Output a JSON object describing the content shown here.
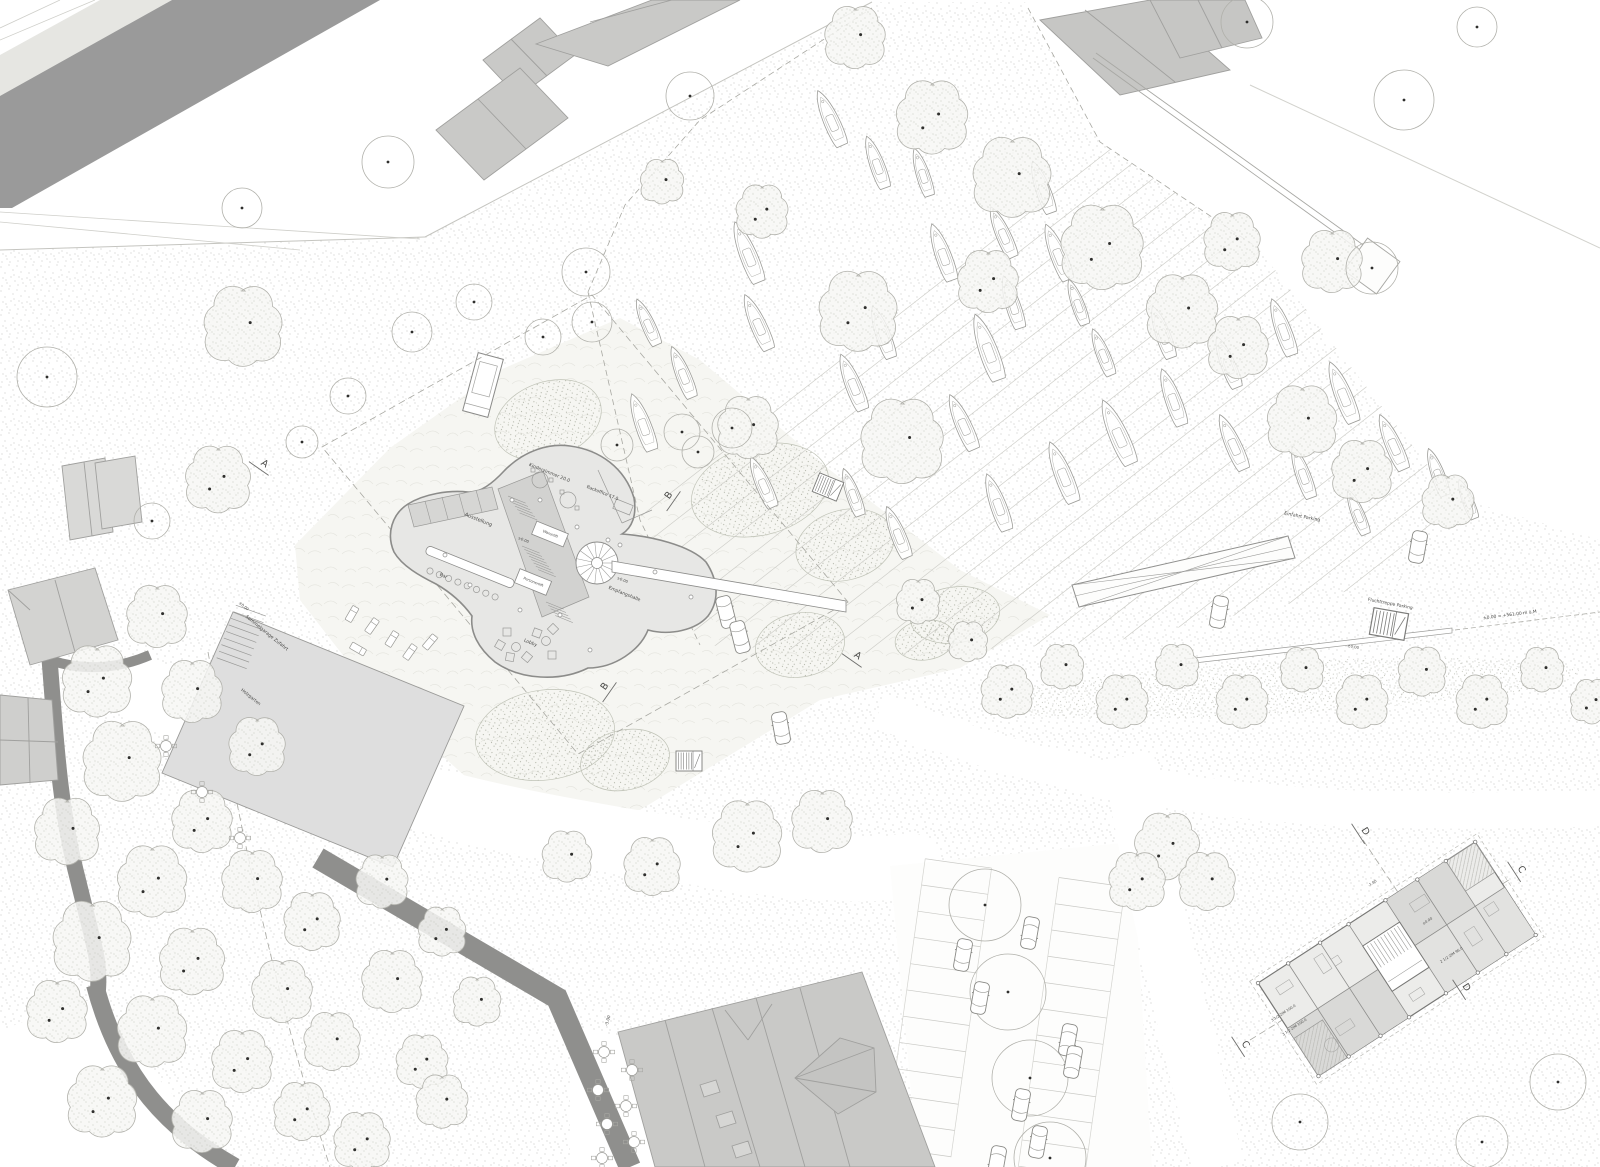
{
  "meta": {
    "type": "architectural-site-plan",
    "view": "top-down plan with marina, park, clover-shaped pavilion and apartment plan"
  },
  "colors": {
    "paper": "#ffffff",
    "road_dark": "#9a9a9a",
    "existing_building": "#c9c9c7",
    "main_building": "#e7e7e5",
    "core": "#d2d2d0",
    "outline": "#8c8c8a",
    "stipple": "#b9b9b3",
    "text": "#4a4a48"
  },
  "labels": [
    {
      "text": "Kinderzimmer 20.0",
      "x": 549,
      "y": 474,
      "rot": 22,
      "size": 4.6
    },
    {
      "text": "Backoffice 17.0",
      "x": 602,
      "y": 494,
      "rot": 22,
      "size": 4.4
    },
    {
      "text": "Ausstellung",
      "x": 478,
      "y": 521,
      "rot": 22,
      "size": 5
    },
    {
      "text": "Warenlift",
      "x": 550,
      "y": 535,
      "rot": 22,
      "size": 3.6
    },
    {
      "text": "Personenlift",
      "x": 533,
      "y": 583,
      "rot": 22,
      "size": 3.6
    },
    {
      "text": "Bar",
      "x": 443,
      "y": 577,
      "rot": 22,
      "size": 4.6
    },
    {
      "text": "Lobby",
      "x": 530,
      "y": 644,
      "rot": 22,
      "size": 4.6
    },
    {
      "text": "Empfangshalle",
      "x": 624,
      "y": 595,
      "rot": 22,
      "size": 4.6
    },
    {
      "text": "±0.00",
      "x": 523,
      "y": 541,
      "rot": 22,
      "size": 3.8
    },
    {
      "text": "±0.00",
      "x": 622,
      "y": 581,
      "rot": 22,
      "size": 3.8
    },
    {
      "text": "Sammelgarage Zufahrt",
      "x": 266,
      "y": 634,
      "rot": 39,
      "size": 4.6
    },
    {
      "text": "±0.00",
      "x": 243,
      "y": 607,
      "rot": 39,
      "size": 3.8
    },
    {
      "text": "Holzgarten",
      "x": 250,
      "y": 698,
      "rot": 39,
      "size": 4.4
    },
    {
      "text": "Einfahrt Parking",
      "x": 1302,
      "y": 518,
      "rot": 11,
      "size": 4.6
    },
    {
      "text": "Fluchttreppe Parking",
      "x": 1390,
      "y": 605,
      "rot": 11,
      "size": 4.4
    },
    {
      "text": "±0.00",
      "x": 1353,
      "y": 648,
      "rot": 11,
      "size": 3.8
    },
    {
      "text": "±0.00 = +561.00 m ü.M",
      "x": 1510,
      "y": 616,
      "rot": -7,
      "size": 4.4
    },
    {
      "text": "-3.00",
      "x": 609,
      "y": 1021,
      "rot": -75,
      "size": 4.2
    },
    {
      "text": "-1.80",
      "x": 1373,
      "y": 884,
      "rot": -33,
      "size": 3.6
    },
    {
      "text": "±0.00",
      "x": 1428,
      "y": 922,
      "rot": -33,
      "size": 3.6
    },
    {
      "text": "2 1/2 ZIM 96.0",
      "x": 1452,
      "y": 956,
      "rot": -33,
      "size": 3.6
    },
    {
      "text": "3 1/2 ZIM 100.0",
      "x": 1284,
      "y": 1014,
      "rot": -33,
      "size": 3.6
    },
    {
      "text": "3 1/2 ZIM 100.0",
      "x": 1295,
      "y": 1028,
      "rot": -33,
      "size": 3.6
    }
  ],
  "section_markers": [
    {
      "letter": "A",
      "x": 263,
      "y": 466,
      "rot": 35
    },
    {
      "letter": "B",
      "x": 671,
      "y": 497,
      "rot": -55
    },
    {
      "letter": "B",
      "x": 607,
      "y": 688,
      "rot": -55
    },
    {
      "letter": "A",
      "x": 856,
      "y": 658,
      "rot": 35
    },
    {
      "letter": "D",
      "x": 1363,
      "y": 833,
      "rot": 57
    },
    {
      "letter": "C",
      "x": 1519,
      "y": 871,
      "rot": 57
    },
    {
      "letter": "D",
      "x": 1464,
      "y": 989,
      "rot": 57
    },
    {
      "letter": "C",
      "x": 1243,
      "y": 1046,
      "rot": 57
    }
  ],
  "trees": {
    "canopy": [
      [
        243,
        327,
        36
      ],
      [
        218,
        480,
        30
      ],
      [
        855,
        38,
        28
      ],
      [
        932,
        118,
        33
      ],
      [
        1012,
        178,
        36
      ],
      [
        1102,
        248,
        38
      ],
      [
        1182,
        312,
        33
      ],
      [
        858,
        312,
        36
      ],
      [
        902,
        442,
        38
      ],
      [
        988,
        282,
        28
      ],
      [
        748,
        428,
        28
      ],
      [
        1238,
        348,
        28
      ],
      [
        1302,
        422,
        32
      ],
      [
        1362,
        472,
        28
      ],
      [
        1448,
        502,
        24
      ],
      [
        1232,
        242,
        26
      ],
      [
        1332,
        262,
        28
      ],
      [
        762,
        212,
        24
      ],
      [
        662,
        182,
        20
      ],
      [
        918,
        602,
        20
      ],
      [
        968,
        642,
        18
      ],
      [
        1007,
        692,
        24
      ],
      [
        1062,
        667,
        20
      ],
      [
        1122,
        702,
        24
      ],
      [
        1177,
        667,
        20
      ],
      [
        1242,
        702,
        24
      ],
      [
        1302,
        670,
        20
      ],
      [
        1362,
        702,
        24
      ],
      [
        1422,
        672,
        22
      ],
      [
        1482,
        702,
        24
      ],
      [
        1542,
        670,
        20
      ],
      [
        1592,
        702,
        20
      ],
      [
        157,
        617,
        28
      ],
      [
        97,
        682,
        32
      ],
      [
        192,
        692,
        28
      ],
      [
        257,
        747,
        26
      ],
      [
        122,
        762,
        36
      ],
      [
        202,
        822,
        28
      ],
      [
        67,
        832,
        30
      ],
      [
        152,
        882,
        32
      ],
      [
        252,
        882,
        28
      ],
      [
        312,
        922,
        26
      ],
      [
        92,
        942,
        36
      ],
      [
        192,
        962,
        30
      ],
      [
        282,
        992,
        28
      ],
      [
        57,
        1012,
        28
      ],
      [
        152,
        1032,
        32
      ],
      [
        242,
        1062,
        28
      ],
      [
        332,
        1042,
        26
      ],
      [
        102,
        1102,
        32
      ],
      [
        202,
        1122,
        28
      ],
      [
        302,
        1112,
        26
      ],
      [
        392,
        982,
        28
      ],
      [
        422,
        1062,
        24
      ],
      [
        382,
        882,
        24
      ],
      [
        442,
        932,
        22
      ],
      [
        477,
        1002,
        22
      ],
      [
        362,
        1142,
        26
      ],
      [
        442,
        1102,
        24
      ],
      [
        747,
        837,
        32
      ],
      [
        822,
        822,
        28
      ],
      [
        652,
        867,
        26
      ],
      [
        567,
        857,
        23
      ],
      [
        1167,
        847,
        30
      ],
      [
        1207,
        882,
        26
      ],
      [
        1137,
        882,
        26
      ]
    ],
    "outline": [
      [
        1247,
        22,
        26
      ],
      [
        1477,
        27,
        20
      ],
      [
        1404,
        100,
        30
      ],
      [
        690,
        96,
        24
      ],
      [
        586,
        272,
        24
      ],
      [
        388,
        162,
        26
      ],
      [
        242,
        208,
        20
      ],
      [
        47,
        377,
        30
      ],
      [
        152,
        521,
        18
      ],
      [
        617,
        445,
        16
      ],
      [
        682,
        432,
        18
      ],
      [
        592,
        322,
        20
      ],
      [
        543,
        337,
        18
      ],
      [
        474,
        302,
        18
      ],
      [
        412,
        332,
        20
      ],
      [
        348,
        396,
        18
      ],
      [
        302,
        442,
        16
      ],
      [
        985,
        905,
        36
      ],
      [
        1008,
        992,
        38
      ],
      [
        1030,
        1078,
        38
      ],
      [
        1050,
        1158,
        36
      ],
      [
        1372,
        268,
        26
      ],
      [
        1300,
        1122,
        28
      ],
      [
        1558,
        1082,
        28
      ],
      [
        1482,
        1142,
        26
      ],
      [
        732,
        428,
        20
      ],
      [
        698,
        452,
        16
      ]
    ]
  },
  "boats": [
    [
      830,
      118,
      60,
      -24
    ],
    [
      876,
      162,
      55,
      -20
    ],
    [
      922,
      172,
      50,
      -18
    ],
    [
      747,
      252,
      65,
      -22
    ],
    [
      757,
      322,
      60,
      -24
    ],
    [
      882,
      332,
      55,
      -20
    ],
    [
      852,
      382,
      60,
      -22
    ],
    [
      987,
      347,
      70,
      -20
    ],
    [
      962,
      422,
      60,
      -24
    ],
    [
      1012,
      302,
      55,
      -18
    ],
    [
      1057,
      252,
      60,
      -22
    ],
    [
      1042,
      187,
      55,
      -20
    ],
    [
      647,
      322,
      50,
      -24
    ],
    [
      682,
      372,
      55,
      -22
    ],
    [
      642,
      422,
      60,
      -20
    ],
    [
      762,
      482,
      55,
      -24
    ],
    [
      852,
      492,
      50,
      -20
    ],
    [
      897,
      532,
      55,
      -22
    ],
    [
      997,
      502,
      60,
      -20
    ],
    [
      1062,
      472,
      65,
      -22
    ],
    [
      1117,
      432,
      70,
      -24
    ],
    [
      1172,
      397,
      60,
      -20
    ],
    [
      1227,
      362,
      55,
      -22
    ],
    [
      1282,
      327,
      60,
      -20
    ],
    [
      1342,
      392,
      65,
      -22
    ],
    [
      1392,
      442,
      60,
      -24
    ],
    [
      1437,
      472,
      50,
      -20
    ],
    [
      1467,
      499,
      42,
      -22
    ],
    [
      1302,
      472,
      55,
      -20
    ],
    [
      1357,
      512,
      48,
      -22
    ],
    [
      1232,
      442,
      60,
      -24
    ],
    [
      1162,
      332,
      55,
      -20
    ],
    [
      1102,
      352,
      50,
      -22
    ],
    [
      942,
      252,
      60,
      -20
    ],
    [
      1002,
      232,
      55,
      -24
    ],
    [
      1077,
      302,
      48,
      -20
    ]
  ],
  "cars": [
    [
      726,
      612,
      76
    ],
    [
      740,
      637,
      76
    ],
    [
      781,
      728,
      80
    ],
    [
      1418,
      547,
      100
    ],
    [
      1219,
      612,
      100
    ],
    [
      963,
      955,
      100
    ],
    [
      1030,
      933,
      280
    ],
    [
      980,
      998,
      100
    ],
    [
      1068,
      1040,
      280
    ],
    [
      1073,
      1062,
      280
    ],
    [
      1021,
      1105,
      100
    ],
    [
      1038,
      1142,
      100
    ],
    [
      997,
      1162,
      280
    ]
  ],
  "furniture": {
    "tables": [
      [
        604,
        1052
      ],
      [
        632,
        1070
      ],
      [
        598,
        1090
      ],
      [
        626,
        1106
      ],
      [
        607,
        1124
      ],
      [
        634,
        1142
      ],
      [
        602,
        1158
      ],
      [
        166,
        746
      ],
      [
        202,
        792
      ],
      [
        240,
        838
      ]
    ],
    "loungers": [
      [
        352,
        614,
        30
      ],
      [
        372,
        626,
        35
      ],
      [
        392,
        639,
        32
      ],
      [
        410,
        652,
        35
      ],
      [
        358,
        649,
        120
      ],
      [
        430,
        642,
        40
      ]
    ]
  },
  "stairs": [
    [
      828,
      487,
      22,
      1
    ],
    [
      689,
      761,
      0,
      1
    ],
    [
      1389,
      624,
      10,
      1.35
    ]
  ],
  "marina_rows": {
    "angle": -38,
    "spacing": 40,
    "count": 26,
    "x0": 380,
    "y0": 720,
    "len": 950
  },
  "parking_lot": {
    "rot": 8,
    "cx": 1010,
    "cy": 1010,
    "y_start": 872,
    "y_end": 1164,
    "step": 26.5,
    "rows": [
      [
        905,
        972
      ],
      [
        1040,
        1107
      ]
    ]
  }
}
